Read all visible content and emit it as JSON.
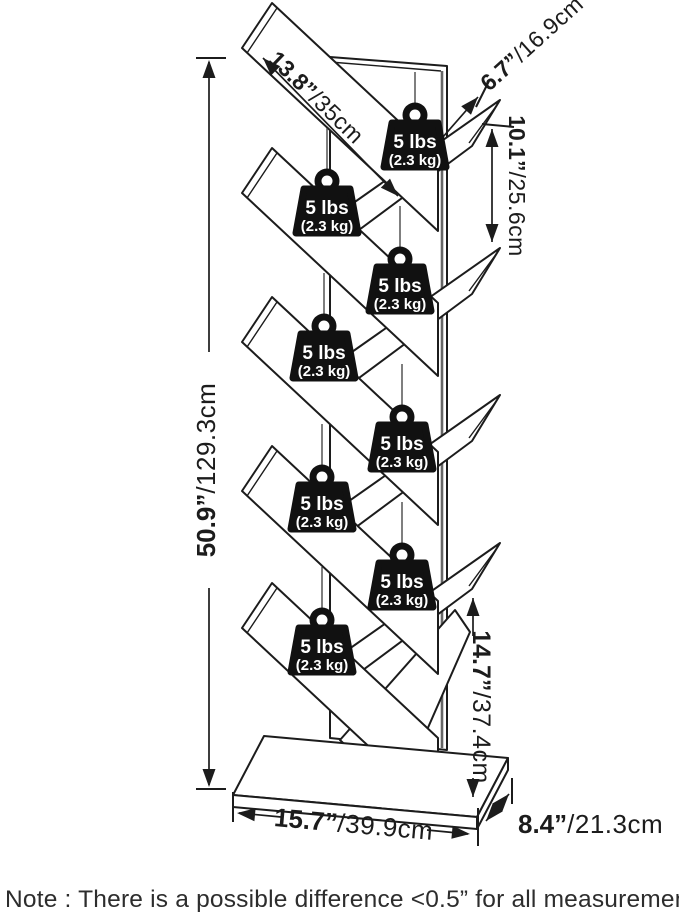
{
  "diagram": {
    "title": "tree-bookshelf-dimension-diagram",
    "weights": {
      "label": "5 lbs",
      "sublabel": "(2.3 kg)",
      "count": 8
    },
    "dimensions": {
      "shelf_length": {
        "imperial": "13.8”",
        "metric": "/35cm"
      },
      "shelf_depth": {
        "imperial": "6.7”",
        "metric": "/16.9cm"
      },
      "shelf_gap": {
        "imperial": "10.1”",
        "metric": "/25.6cm"
      },
      "total_height": {
        "imperial": "50.9”",
        "metric": "/129.3cm"
      },
      "bottom_gap": {
        "imperial": "14.7”",
        "metric": "/37.4cm"
      },
      "base_width": {
        "imperial": "15.7”",
        "metric": "/39.9cm"
      },
      "base_depth": {
        "imperial": "8.4”",
        "metric": "/21.3cm"
      }
    },
    "colors": {
      "line": "#1c1c1c",
      "spine_shadow": "#666666",
      "weight_fill": "#111111",
      "background": "#ffffff"
    }
  },
  "note": "Note : There is a possible difference <0.5” for all measurements."
}
